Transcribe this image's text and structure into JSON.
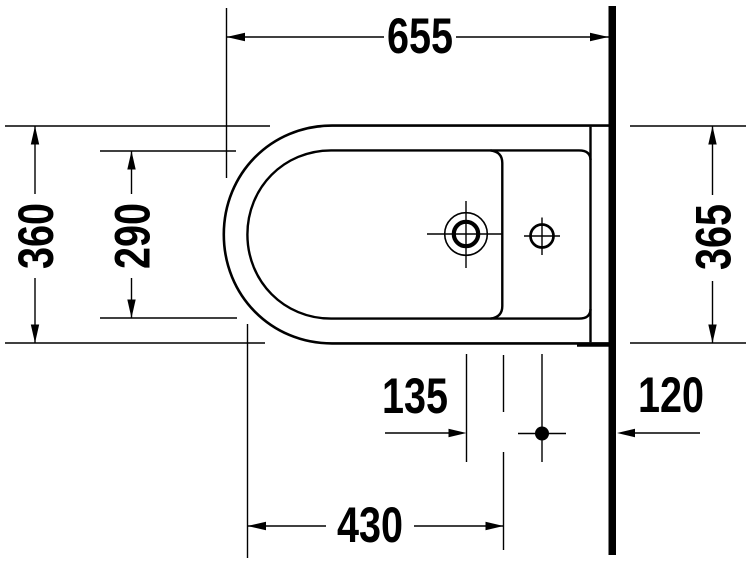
{
  "diagram": {
    "type": "technical-drawing",
    "subject": "wall-mounted bidet top view with installation dimensions",
    "unit": "mm",
    "colors": {
      "line": "#000000",
      "background": "#ffffff",
      "wall": "#000000"
    },
    "labels": {
      "overall_length": "655",
      "overall_width": "360",
      "inner_rim_width": "290",
      "side_projection": "365",
      "tap_hole_to_fixing_point": "135",
      "wall_to_fixing_point": "120",
      "front_to_fixing_point": "430"
    },
    "symbols": {
      "tap_hole": "circle-with-crosshair",
      "side_hole": "circle-with-crosshair",
      "fixing_point": "filled-dot-with-crosshair",
      "wall": "thick-vertical-line"
    }
  }
}
